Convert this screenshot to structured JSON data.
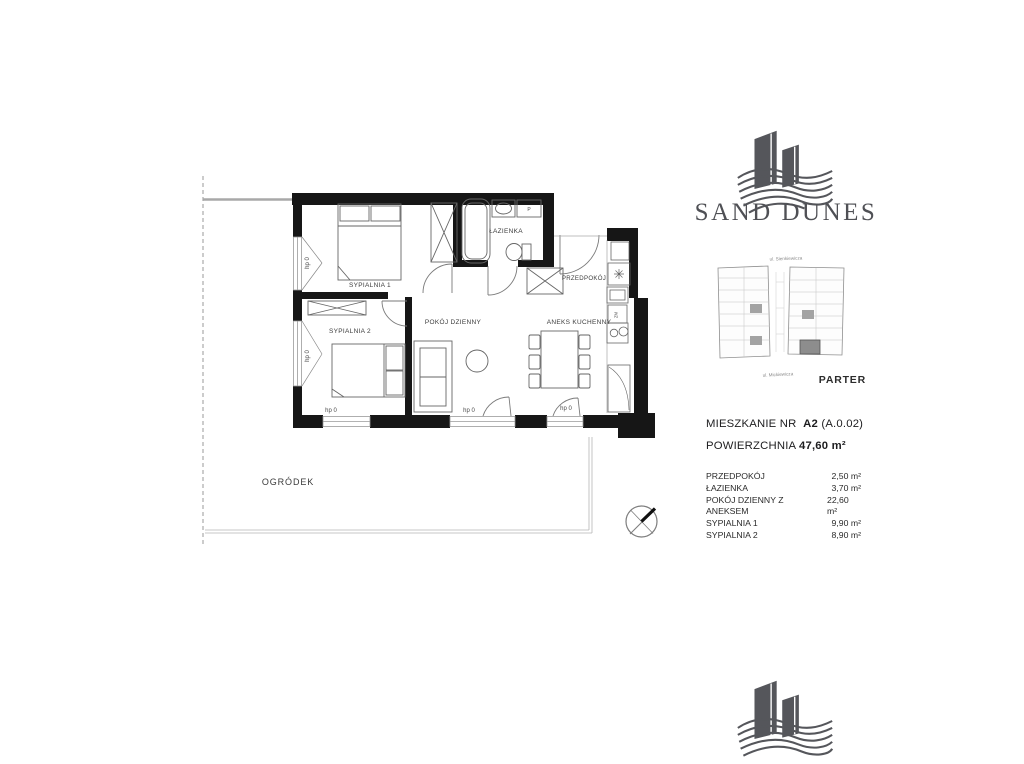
{
  "brand": {
    "name": "SAND DUNES"
  },
  "site_plan": {
    "street_top": "ul. Sienkiewicza",
    "street_bottom": "ul. Mickiewicza",
    "floor_label": "PARTER"
  },
  "apartment": {
    "title_prefix": "MIESZKANIE NR",
    "unit_number": "A2",
    "unit_code": "(A.0.02)",
    "area_label": "POWIERZCHNIA",
    "area_value": "47,60 m²"
  },
  "room_table": {
    "rows": [
      {
        "name": "PRZEDPOKÓJ",
        "area": "2,50 m²"
      },
      {
        "name": "ŁAZIENKA",
        "area": "3,70 m²"
      },
      {
        "name": "POKÓJ DZIENNY Z ANEKSEM",
        "area": "22,60 m²"
      },
      {
        "name": "SYPIALNIA 1",
        "area": "9,90 m²"
      },
      {
        "name": "SYPIALNIA 2",
        "area": "8,90 m²"
      }
    ]
  },
  "floor_plan": {
    "rooms": {
      "bedroom1": "SYPIALNIA 1",
      "bedroom2": "SYPIALNIA 2",
      "bathroom": "ŁAZIENKA",
      "hallway": "PRZEDPOKÓJ",
      "living_room": "POKÓJ DZIENNY",
      "kitchenette": "ANEKS KUCHENNY",
      "garden": "OGRÓDEK"
    },
    "annotations": {
      "sill_height": "hp 0",
      "washer": "P",
      "dishwasher": "ZM"
    }
  },
  "colors": {
    "wall": "#161616",
    "logo_gray": "#55565b",
    "text_dark": "#1d1d1f",
    "highlight_unit": "#8d8d8d"
  }
}
